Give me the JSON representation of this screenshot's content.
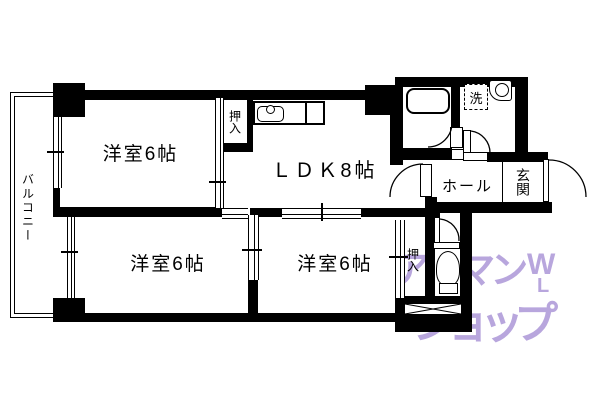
{
  "plan": {
    "rooms": {
      "room_top_left": "洋室6帖",
      "ldk": "ＬＤＫ8帖",
      "room_bottom_left": "洋室6帖",
      "room_bottom_center": "洋室6帖",
      "closet_top": "押入",
      "closet_bottom": "押入",
      "hall": "ホール",
      "entrance": "玄関",
      "balcony": "バルコニー",
      "laundry": "洗"
    },
    "watermark": {
      "line1": "アパマン",
      "line2": "ショップ",
      "logo_top": "W",
      "logo_bottom": "L",
      "color": "#b8a6dd"
    },
    "colors": {
      "wall": "#000000",
      "background": "#ffffff"
    }
  }
}
